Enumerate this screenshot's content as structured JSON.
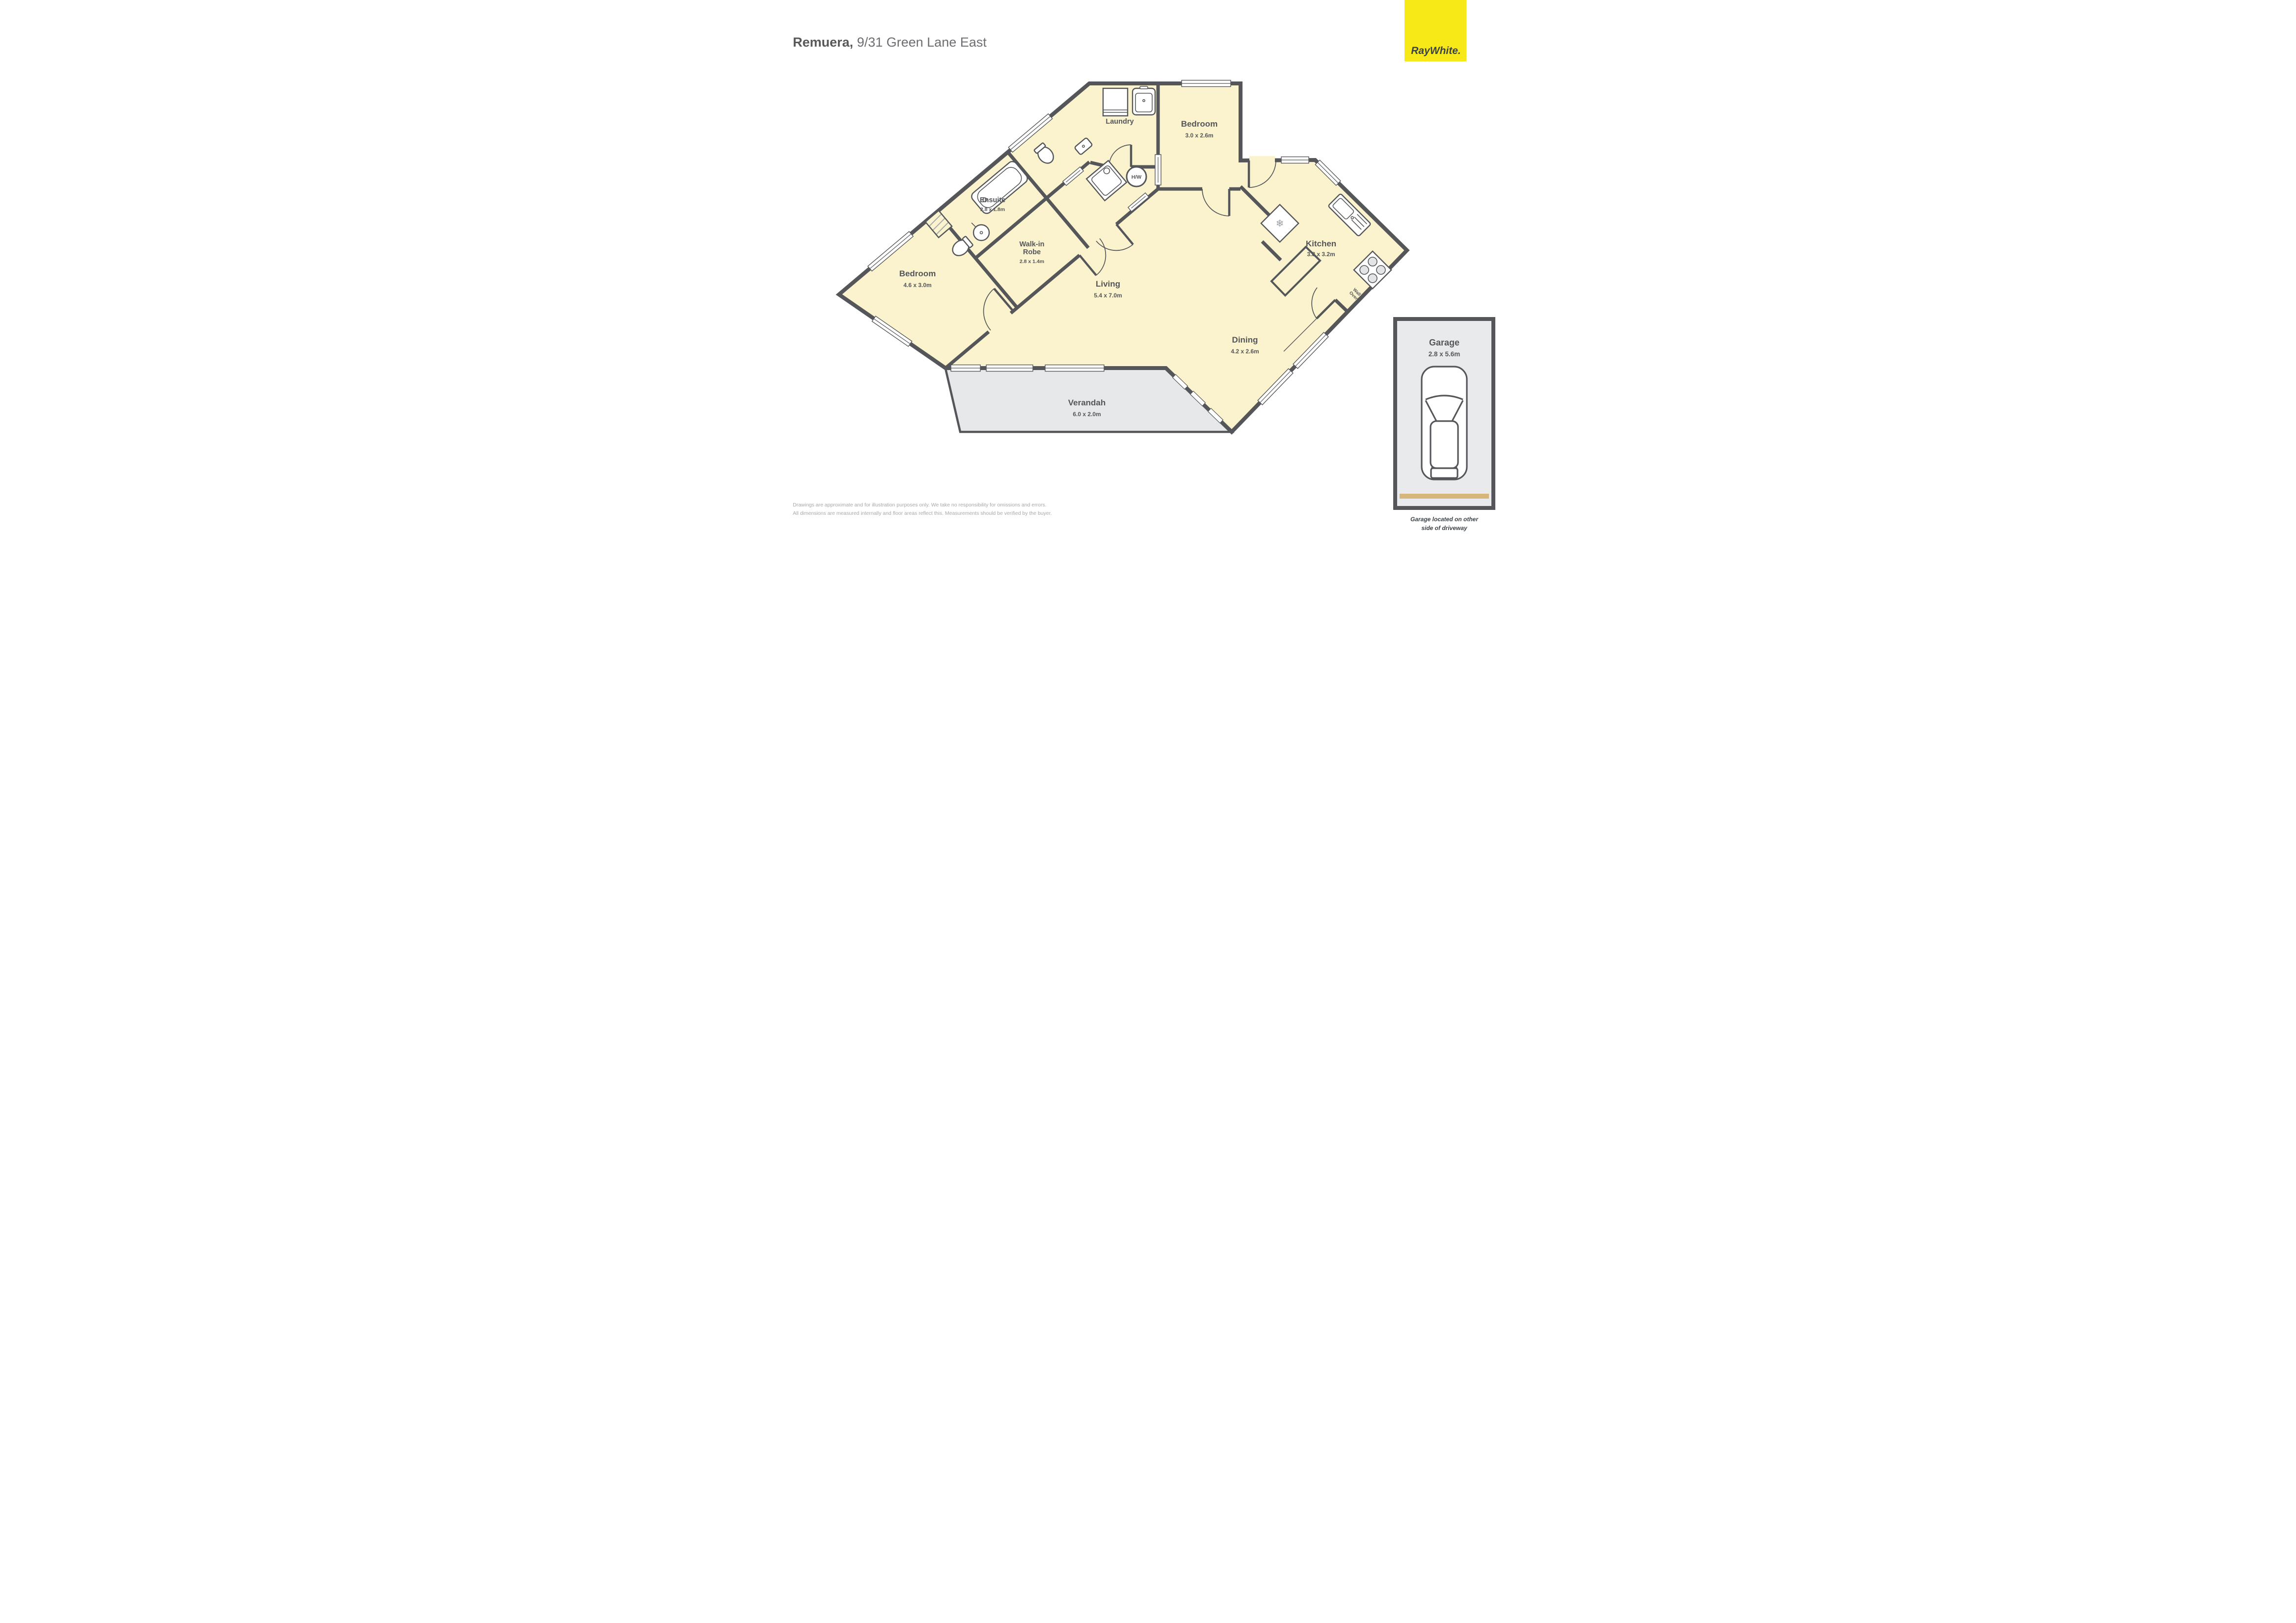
{
  "title": {
    "suburb": "Remuera,",
    "address": " 9/31 Green Lane East"
  },
  "logo": {
    "brand": "RayWhite."
  },
  "plan": {
    "rooms": {
      "ensuite": {
        "name": "Ensuite",
        "dims": "2.8 x 1.8m"
      },
      "walk_in_robe": {
        "name_line1": "Walk-in",
        "name_line2": "Robe",
        "dims": "2.8 x 1.4m"
      },
      "laundry": {
        "name": "Laundry"
      },
      "bedroom_small": {
        "name": "Bedroom",
        "dims": "3.0 x 2.6m"
      },
      "bedroom_main": {
        "name": "Bedroom",
        "dims": "4.6 x 3.0m"
      },
      "kitchen": {
        "name": "Kitchen",
        "dims": "3.8 x 3.2m"
      },
      "living": {
        "name": "Living",
        "dims": "5.4 x 7.0m"
      },
      "dining": {
        "name": "Dining",
        "dims": "4.2 x 2.6m"
      },
      "verandah": {
        "name": "Verandah",
        "dims": "6.0 x 2.0m"
      }
    },
    "labels": {
      "hot_water": "H/W",
      "wall_oven_line1": "Wall",
      "wall_oven_line2": "Oven",
      "snowflake": "❄"
    }
  },
  "garage": {
    "name": "Garage",
    "dims": "2.8 x 5.6m",
    "caption_line1": "Garage located on other",
    "caption_line2": "side of driveway"
  },
  "disclaimer": {
    "line1": "Drawings are approximate and for illustration purposes only.  We take no responsibility for omissions and errors.",
    "line2": "All dimensions are measured internally and floor areas reflect this.  Measurements should be verified by the buyer."
  },
  "colors": {
    "wall": "#54565a",
    "floor": "#faf3ce",
    "outdoor": "#e7e8e9",
    "garage_fill": "#e9eaeb",
    "brand_yellow": "#f7e917",
    "garage_door_tan": "#d7b67c",
    "hatch_gray": "#a7a9ac"
  }
}
